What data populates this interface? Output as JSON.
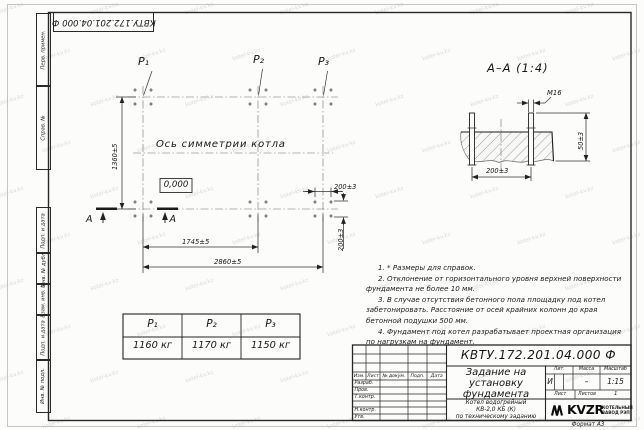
{
  "sheet": {
    "doc_number_rotated": "КВТУ.172.201.04.000 Ф",
    "margin_labels": [
      "Перв. примен.",
      "Справ. №",
      "Подп. и дата",
      "Инв. № дубл.",
      "Взам. инв. №",
      "Подп. и дата",
      "Инв. № подл."
    ],
    "format_note": "Формат А3",
    "watermark_text": "kotel-kv.kz"
  },
  "plan": {
    "points": [
      "P₁",
      "P₂",
      "P₃"
    ],
    "symmetry_axis_label": "Ось симметрии котла",
    "level_mark": "0,000",
    "dim_height": "1360±5",
    "dim_span_inner": "1745±5",
    "dim_span_outer": "2860±5",
    "dim_bolt_spacing_x": "200±3",
    "dim_bolt_spacing_y": "200±3",
    "section_mark_letter_left": "А",
    "section_mark_letter_right": "А"
  },
  "section_view": {
    "title": "А–А (1:4)",
    "thread_label": "М16",
    "dim_protrusion": "50±3",
    "dim_bolt_spacing": "200±3"
  },
  "loads_table": {
    "headers": [
      "P₁",
      "P₂",
      "P₃"
    ],
    "values": [
      "1160 кг",
      "1170 кг",
      "1150 кг"
    ]
  },
  "notes": [
    "1. * Размеры для справок.",
    "2. Отклонение от горизонтального уровня верхней поверхности фундамента не более 10 мм.",
    "3. В случае отсутствия бетонного пола площадку под котел забетонировать. Расстояние от осей крайних колонн до края бетонной подушки 500 мм.",
    "4. Фундамент под котел разрабатывает проектная организация по нагрузкам на фундамент."
  ],
  "title_block": {
    "doc_number": "КВТУ.172.201.04.000 Ф",
    "title_lines": [
      "Задание на",
      "установку",
      "фундамента"
    ],
    "product_lines": [
      "Котел водогрейный",
      "КВ-2,0 КБ (К)",
      "по техническому заданию"
    ],
    "lit_header": "Лит.",
    "mass_header": "Масса",
    "scale_header": "Масштаб",
    "lit_value": "И",
    "mass_value": "–",
    "scale_value": "1:15",
    "sheet_label": "Лист",
    "sheets_label": "Листов",
    "sheets_value": "1",
    "sig_col_headers": [
      "Изм.",
      "Лист",
      "№ докум.",
      "Подп.",
      "Дата"
    ],
    "sig_row_labels": [
      "Разраб.",
      "Пров.",
      "Т.контр.",
      "Н.контр.",
      "Утв."
    ],
    "company": {
      "logo": "KVZR",
      "caption_lines": [
        "КОТЕЛЬНЫЙ",
        "ЗАВОД РЭП"
      ]
    }
  }
}
